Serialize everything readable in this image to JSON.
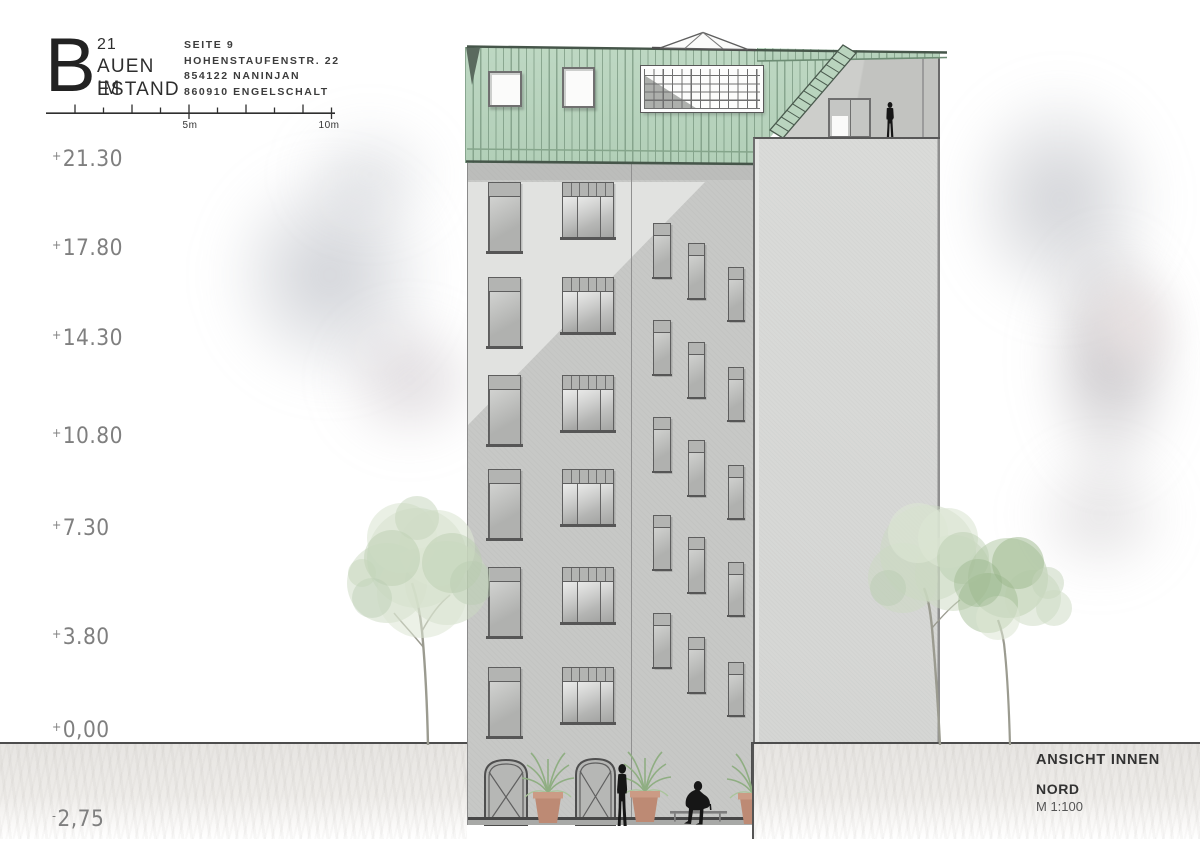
{
  "meta": {
    "canvas_width": 1200,
    "canvas_height": 849
  },
  "title_block": {
    "big_letter": "B",
    "top_number": "21",
    "name_line1": "AUEN IM",
    "name_line2": "ESTAND",
    "address_lines": [
      "SEITE 9",
      "HOHENSTAUFENSTR. 22",
      "854122 NANINJAN",
      "860910 ENGELSCHALT"
    ]
  },
  "scale_bar": {
    "labels": [
      {
        "text": "5m",
        "x": 166
      },
      {
        "text": "10m",
        "x": 305
      }
    ]
  },
  "elevation_labels": [
    {
      "text": "+21.30",
      "y": 162
    },
    {
      "text": "+17.80",
      "y": 251
    },
    {
      "text": "+14.30",
      "y": 341
    },
    {
      "text": "+10.80",
      "y": 439
    },
    {
      "text": "+7.30",
      "y": 531
    },
    {
      "text": "+3.80",
      "y": 640
    },
    {
      "text": "+0,00",
      "y": 733
    },
    {
      "text": "-2,75",
      "y": 822
    }
  ],
  "drawing_info": {
    "title": "ANSICHT INNEN",
    "orientation": "NORD",
    "scale": "M 1:100"
  },
  "colors": {
    "roof_green": "#b8d3bd",
    "roof_seam": "#6e8c74",
    "roof_edge": "#46564a",
    "facade": "#c7c8c6",
    "facade_highlight": "#e1e2e0",
    "blank_wall": "#d8d9d7",
    "terrace_wall": "#cdcecb",
    "window_frame": "#5e5e5e",
    "window_glass": "#b3b4b2",
    "skylight_white": "#fbfbfa",
    "ground": "#e7e5e2",
    "ground_line": "#4d4d4d",
    "tree_foliage": "#c8d6bd",
    "tree_trunk": "#9b9b90",
    "pot_terracotta": "#bd8a74",
    "silhouette": "#161616",
    "text_dark": "#2e2e2e",
    "text_light": "#7f7f7f"
  }
}
